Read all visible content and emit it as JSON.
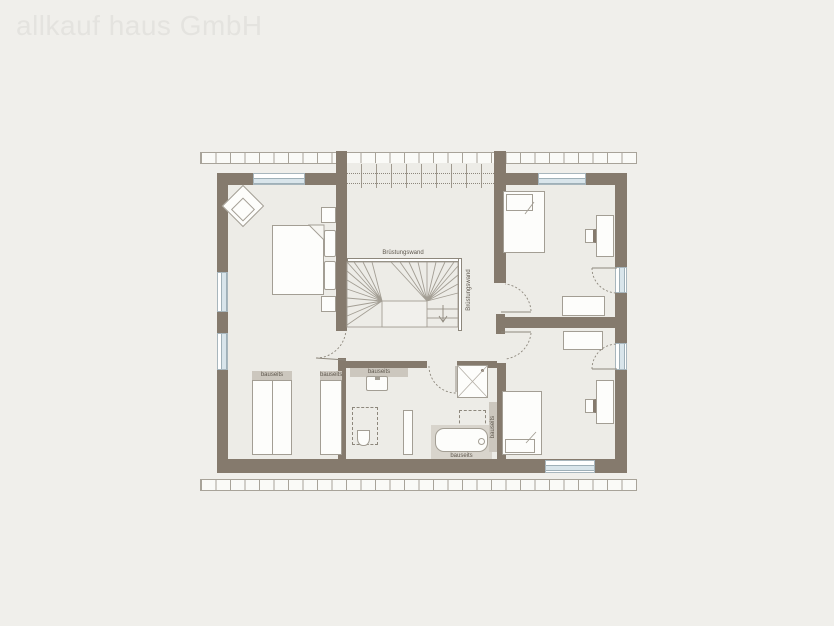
{
  "watermark": {
    "text": "allkauf haus GmbH"
  },
  "labels": {
    "parapet_top": "Brüstungswand",
    "parapet_side": "Brüstungswand",
    "wardrobe_large": "bauseits",
    "wardrobe_small": "bauseits",
    "vanity": "bauseits",
    "bathtub": "bauseits",
    "bath_side": "bauseits"
  },
  "colors": {
    "background": "#f0efeb",
    "wall": "#857a6d",
    "floor": "#edece7",
    "window_glass": "#d9e5eb",
    "line": "#a39e94",
    "fixture_strip": "#ccc7be",
    "label_text": "#5f584e",
    "watermark": "#e4e3df"
  }
}
